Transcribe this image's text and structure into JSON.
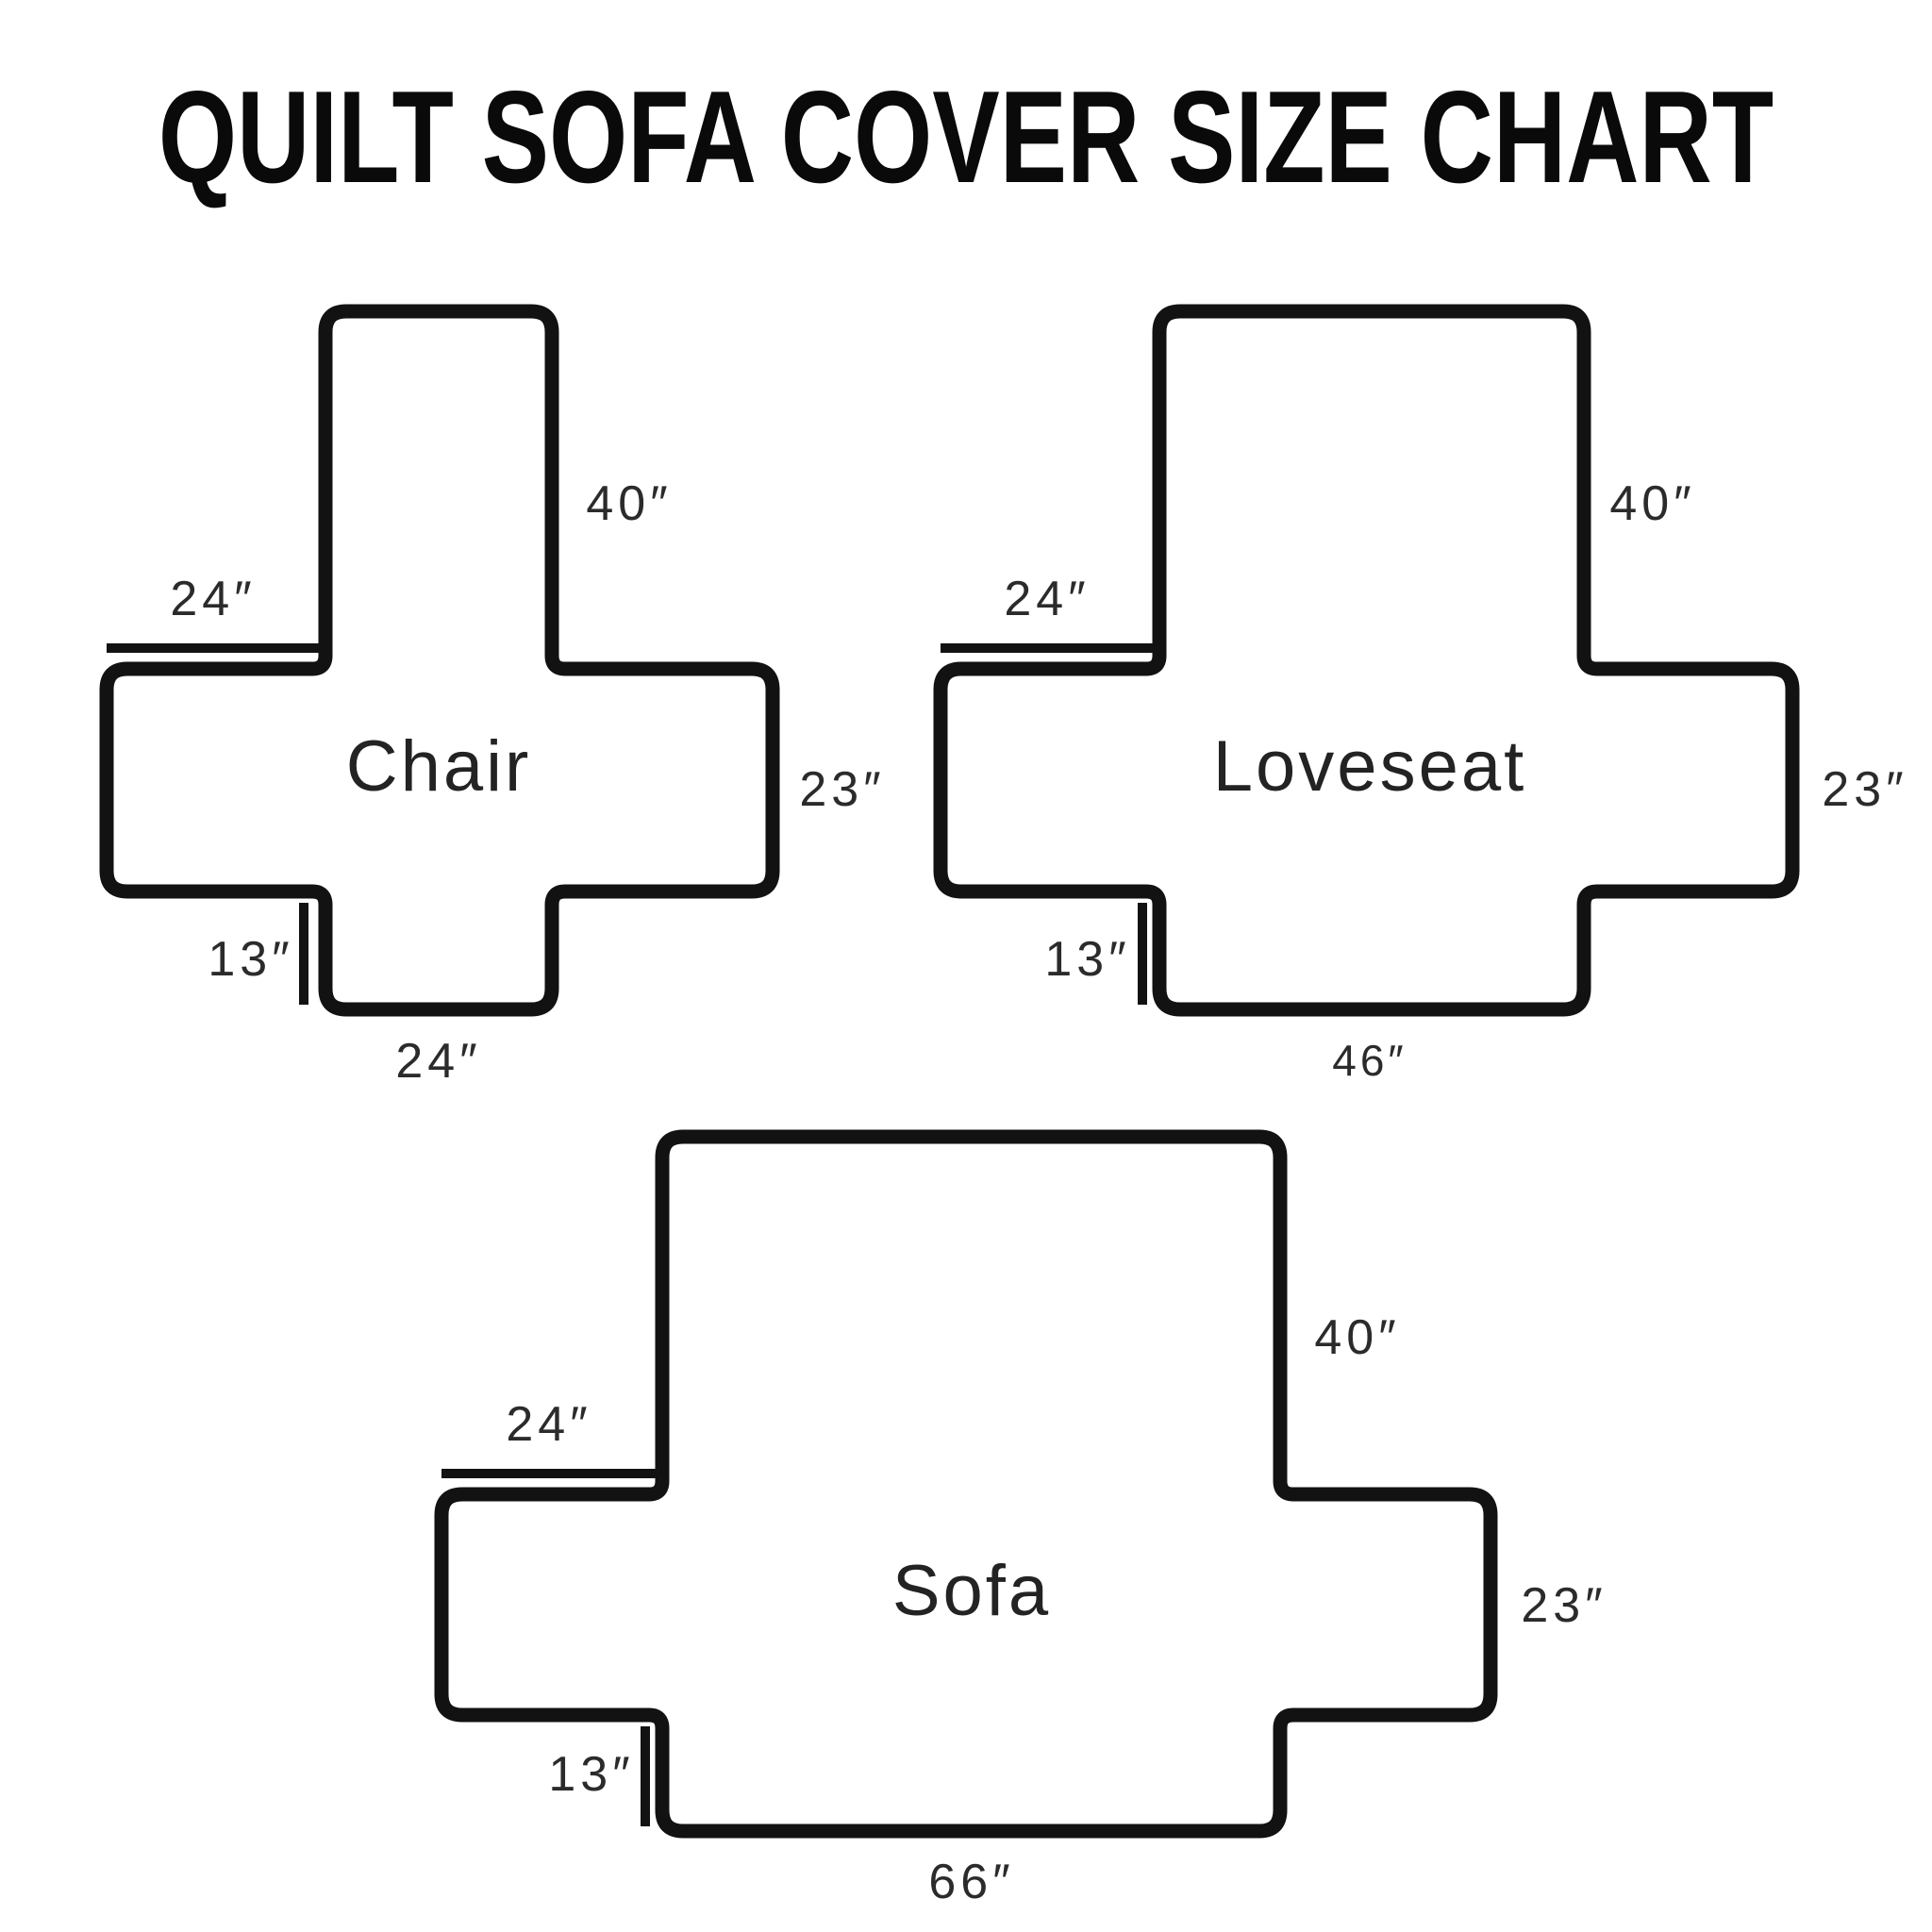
{
  "title": "QUILT SOFA COVER SIZE CHART",
  "colors": {
    "background": "#ffffff",
    "outline": "#121212",
    "label_text": "#2b2b2b",
    "title_text": "#0a0a0a"
  },
  "diagrams": [
    {
      "name": "Chair",
      "back_height": "40″",
      "arm_top_width": "24″",
      "arm_height": "23″",
      "skirt_depth": "13″",
      "bottom_width": "24″"
    },
    {
      "name": "Loveseat",
      "back_height": "40″",
      "arm_top_width": "24″",
      "arm_height": "23″",
      "skirt_depth": "13″",
      "bottom_width": "46″"
    },
    {
      "name": "Sofa",
      "back_height": "40″",
      "arm_top_width": "24″",
      "arm_height": "23″",
      "skirt_depth": "13″",
      "bottom_width": "66″"
    }
  ]
}
